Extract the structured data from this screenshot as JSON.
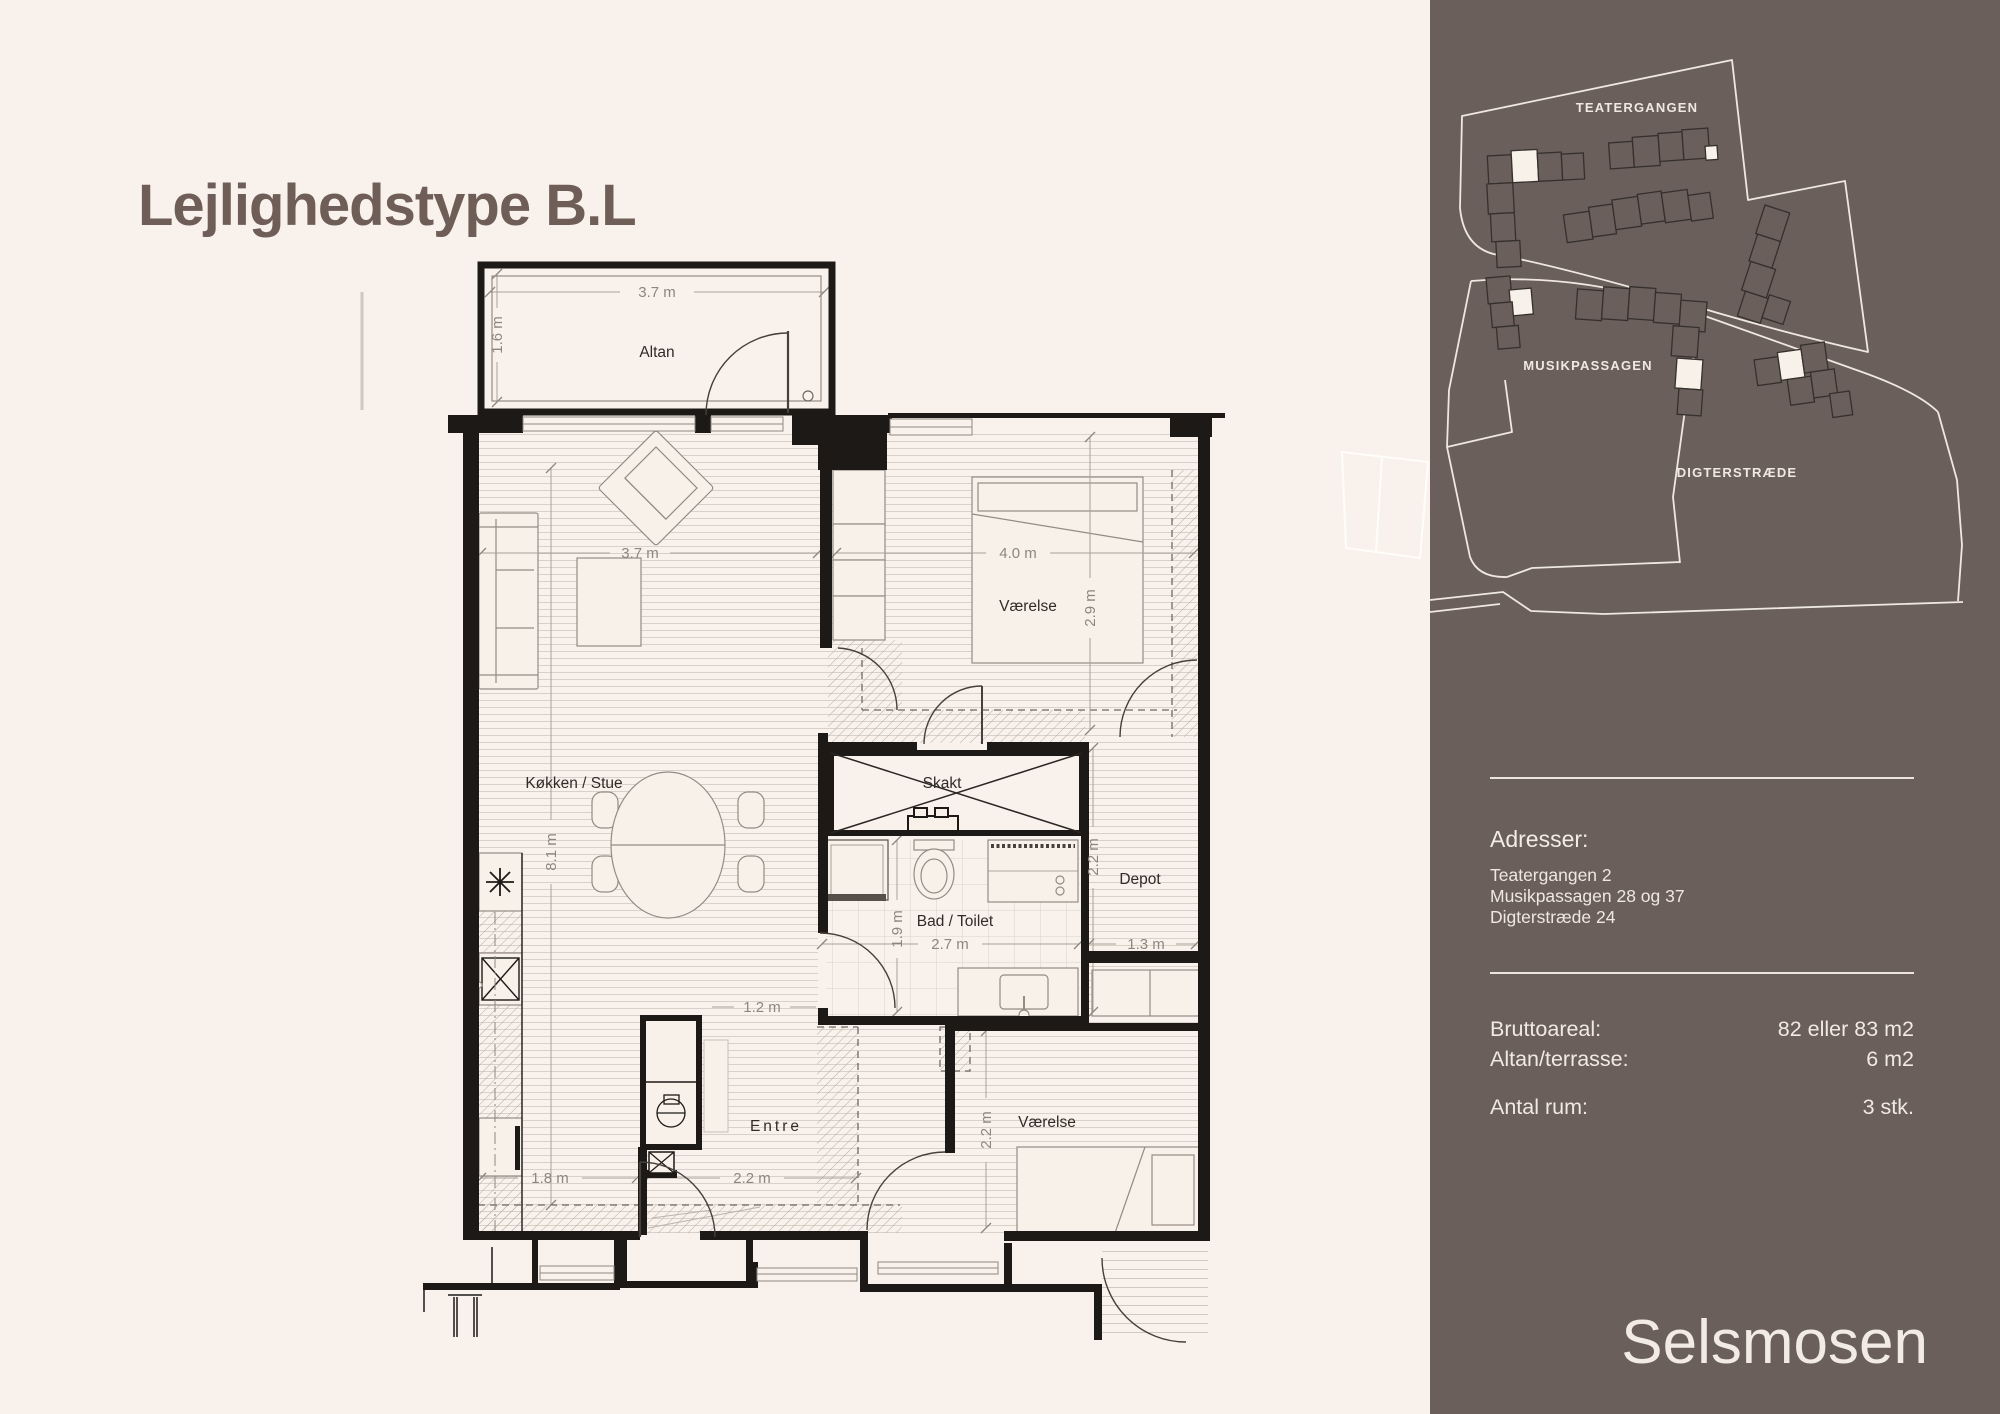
{
  "header": {
    "title": "Lejlighedstype B.L"
  },
  "floorplan": {
    "rooms": {
      "altan": "Altan",
      "stue": "Køkken / Stue",
      "bedroom1": "Værelse",
      "skakt": "Skakt",
      "bath": "Bad / Toilet",
      "depot": "Depot",
      "entre": "Entre",
      "bedroom2": "Værelse"
    },
    "dims": {
      "altan_w": "3.7 m",
      "altan_h": "1.6 m",
      "stue_w": "3.7 m",
      "stue_h": "8.1 m",
      "bedroom1_w": "4.0 m",
      "bedroom1_h": "2.9 m",
      "bath_w": "2.7 m",
      "bath_h": "1.9 m",
      "depot_w": "1.3 m",
      "depot_h": "2.2 m",
      "entre_w": "1.2 m",
      "kitchen_w": "1.8 m",
      "hall_w": "2.2 m",
      "bedroom2_h": "2.2 m"
    }
  },
  "sidebar": {
    "map_labels": {
      "teatergangen": "TEATERGANGEN",
      "musikpassagen": "MUSIKPASSAGEN",
      "digterstraede": "DIGTERSTRÆDE"
    },
    "addresses": {
      "heading": "Adresser:",
      "lines": [
        "Teatergangen 2",
        "Musikpassagen 28 og 37",
        "Digterstræde 24"
      ]
    },
    "facts": [
      {
        "label": "Bruttoareal:",
        "value": "82 eller 83 m2"
      },
      {
        "label": "Altan/terrasse:",
        "value": "6 m2"
      },
      {
        "label": "Antal rum:",
        "value": "3 stk."
      }
    ],
    "brand": "Selsmosen"
  }
}
